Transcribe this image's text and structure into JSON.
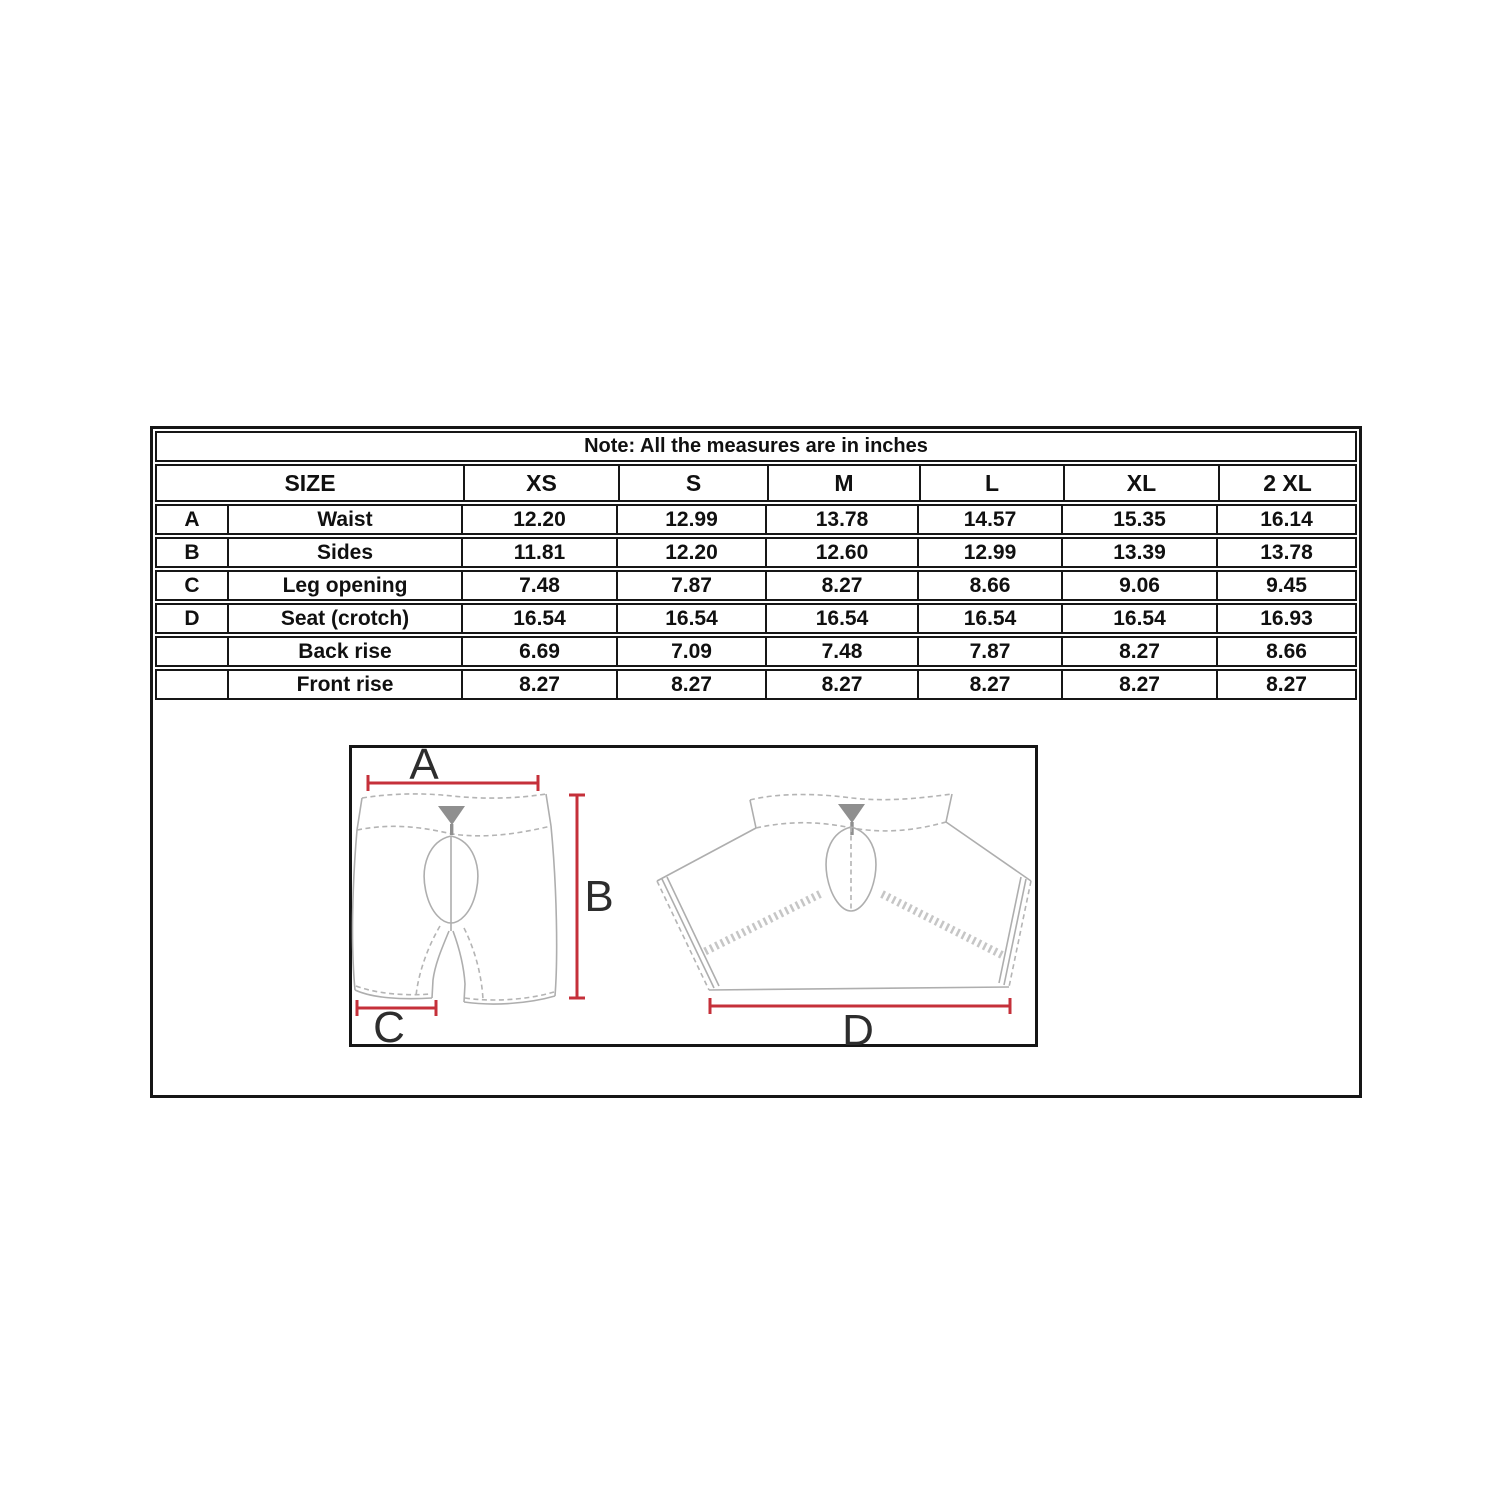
{
  "note": "Note: All the measures are in inches",
  "size_table": {
    "size_header_label": "SIZE",
    "size_columns": [
      "XS",
      "S",
      "M",
      "L",
      "XL",
      "2 XL"
    ],
    "rows": [
      {
        "letter": "A",
        "label": "Waist",
        "values": [
          "12.20",
          "12.99",
          "13.78",
          "14.57",
          "15.35",
          "16.14"
        ]
      },
      {
        "letter": "B",
        "label": "Sides",
        "values": [
          "11.81",
          "12.20",
          "12.60",
          "12.99",
          "13.39",
          "13.78"
        ]
      },
      {
        "letter": "C",
        "label": "Leg opening",
        "values": [
          "7.48",
          "7.87",
          "8.27",
          "8.66",
          "9.06",
          "9.45"
        ]
      },
      {
        "letter": "D",
        "label": "Seat (crotch)",
        "values": [
          "16.54",
          "16.54",
          "16.54",
          "16.54",
          "16.54",
          "16.93"
        ]
      },
      {
        "letter": "",
        "label": "Back rise",
        "values": [
          "6.69",
          "7.09",
          "7.48",
          "7.87",
          "8.27",
          "8.66"
        ]
      },
      {
        "letter": "",
        "label": "Front rise",
        "values": [
          "8.27",
          "8.27",
          "8.27",
          "8.27",
          "8.27",
          "8.27"
        ]
      }
    ]
  },
  "diagram": {
    "labels": {
      "a": "A",
      "b": "B",
      "c": "C",
      "d": "D"
    },
    "dimension_line_color": "#c5303a",
    "sketch_line_color": "#aeaeae"
  }
}
